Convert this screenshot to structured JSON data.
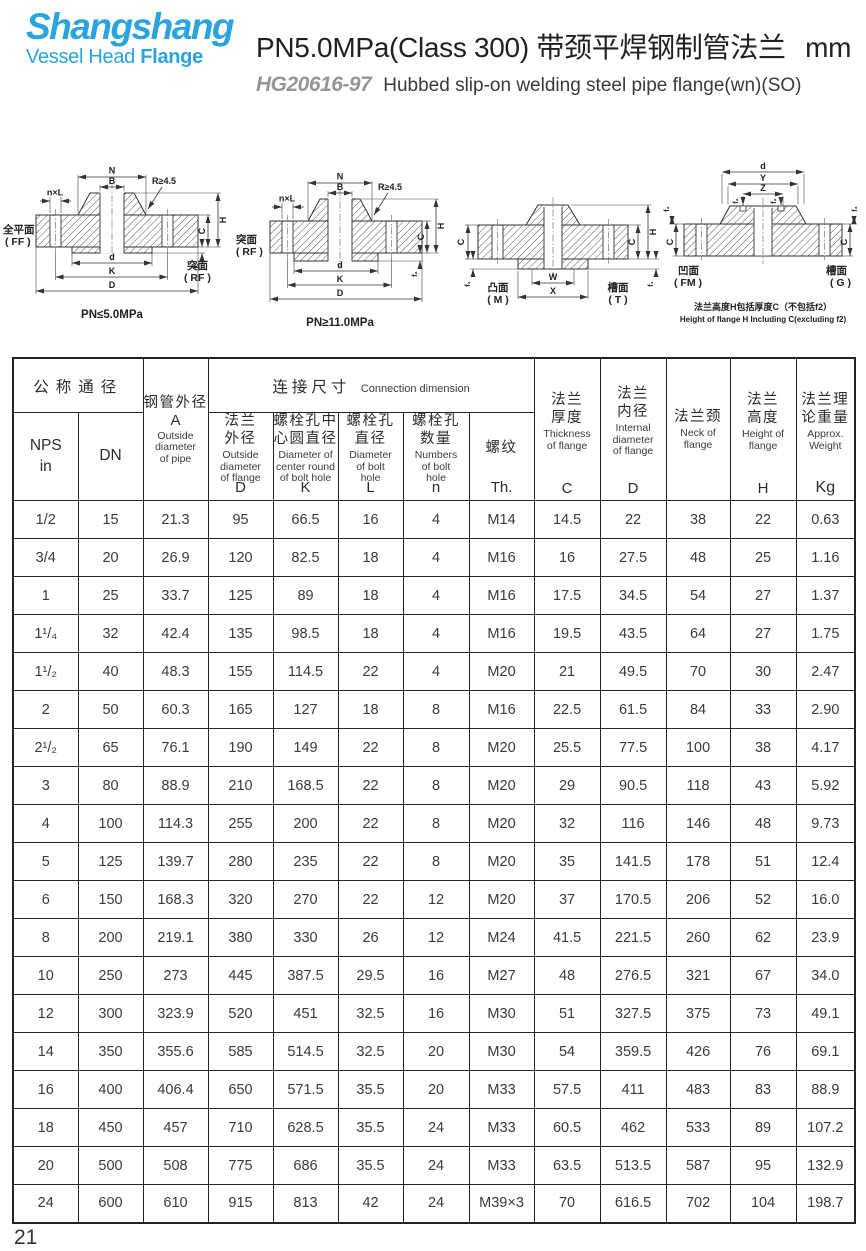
{
  "logo": {
    "name": "Shangshang",
    "tagline_a": "Vessel Head ",
    "tagline_b": "Flange"
  },
  "header": {
    "title_code": "PN5.0MPa(Class 300)",
    "title_zh": "带颈平焊钢制管法兰",
    "title_unit": "mm",
    "standard": "HG20616-97",
    "subtitle_en": "Hubbed slip-on welding steel pipe flange(wn)(SO)"
  },
  "drawings": {
    "d1": {
      "dim_n": "N",
      "dim_b": "B",
      "dim_nxl": "n×L",
      "dim_r": "R≥4.5",
      "dim_d": "d",
      "dim_k": "K",
      "dim_big_d": "D",
      "dim_h": "H",
      "dim_c": "C",
      "dim_f": "f₁",
      "face_left_zh": "全平面",
      "face_left_en": "( FF )",
      "face_right_zh": "突面",
      "face_right_en": "( RF )",
      "caption": "PN≤5.0MPa"
    },
    "d2": {
      "dim_n": "N",
      "dim_b": "B",
      "dim_nxl": "n×L",
      "dim_r": "R≥4.5",
      "dim_d": "d",
      "dim_k": "K",
      "dim_big_d": "D",
      "dim_h": "H",
      "dim_c": "C",
      "dim_f": "f₂",
      "face_left_zh": "突面",
      "face_left_en": "( RF )",
      "caption": "PN≥11.0MPa"
    },
    "d3": {
      "dim_c": "C",
      "dim_f": "f₂",
      "dim_w": "W",
      "dim_x": "X",
      "dim_h": "H",
      "face_left_zh": "凸面",
      "face_left_en": "( M )",
      "face_right_zh": "槽面",
      "face_right_en": "( T )"
    },
    "d4": {
      "dim_d": "d",
      "dim_y": "Y",
      "dim_z": "Z",
      "dim_f2": "f₂",
      "dim_f3": "f₃",
      "dim_c": "C",
      "face_left_zh": "凹面",
      "face_left_en": "( FM )",
      "face_right_zh": "槽面",
      "face_right_en": "( G )",
      "note_zh": "法兰高度H包括厚度C（不包括f2）",
      "note_en": "Height of flange H Including C(excluding f2)"
    }
  },
  "table": {
    "nominal_group": "公称通径",
    "connection_group_zh": "连接尺寸",
    "connection_group_en": "Connection dimension",
    "cols": [
      {
        "zh": "NPS\nin"
      },
      {
        "zh": "DN"
      },
      {
        "zh": "钢管外径",
        "sym": "A",
        "en": "Outside\ndiameter\nof pipe"
      },
      {
        "zh": "法兰\n外径",
        "en": "Outside\ndiameter\nof flange",
        "sym": "D"
      },
      {
        "zh": "螺栓孔中\n心圆直径",
        "en": "Diameter of\ncenter round\nof bolt hole",
        "sym": "K"
      },
      {
        "zh": "螺栓孔\n直径",
        "en": "Diameter\nof bolt\nhole",
        "sym": "L"
      },
      {
        "zh": "螺栓孔\n数量",
        "en": "Numbers\nof bolt\nhole",
        "sym": "n"
      },
      {
        "zh": "螺纹",
        "sym": "Th."
      },
      {
        "zh": "法兰\n厚度",
        "en": "Thickness\nof flange",
        "sym": "C"
      },
      {
        "zh": "法兰\n内径",
        "en": "Internal\ndiameter\nof flange",
        "sym": "D"
      },
      {
        "zh": "法兰颈",
        "en": "Neck of\nflange"
      },
      {
        "zh": "法兰\n高度",
        "en": "Height of\nflange",
        "sym": "H"
      },
      {
        "zh": "法兰理\n论重量",
        "en": "Approx.\nWeight",
        "sym": "Kg"
      }
    ],
    "rows": [
      [
        "1/2",
        "15",
        "21.3",
        "95",
        "66.5",
        "16",
        "4",
        "M14",
        "14.5",
        "22",
        "38",
        "22",
        "0.63"
      ],
      [
        "3/4",
        "20",
        "26.9",
        "120",
        "82.5",
        "18",
        "4",
        "M16",
        "16",
        "27.5",
        "48",
        "25",
        "1.16"
      ],
      [
        "1",
        "25",
        "33.7",
        "125",
        "89",
        "18",
        "4",
        "M16",
        "17.5",
        "34.5",
        "54",
        "27",
        "1.37"
      ],
      [
        "1¹/₄",
        "32",
        "42.4",
        "135",
        "98.5",
        "18",
        "4",
        "M16",
        "19.5",
        "43.5",
        "64",
        "27",
        "1.75"
      ],
      [
        "1¹/₂",
        "40",
        "48.3",
        "155",
        "114.5",
        "22",
        "4",
        "M20",
        "21",
        "49.5",
        "70",
        "30",
        "2.47"
      ],
      [
        "2",
        "50",
        "60.3",
        "165",
        "127",
        "18",
        "8",
        "M16",
        "22.5",
        "61.5",
        "84",
        "33",
        "2.90"
      ],
      [
        "2¹/₂",
        "65",
        "76.1",
        "190",
        "149",
        "22",
        "8",
        "M20",
        "25.5",
        "77.5",
        "100",
        "38",
        "4.17"
      ],
      [
        "3",
        "80",
        "88.9",
        "210",
        "168.5",
        "22",
        "8",
        "M20",
        "29",
        "90.5",
        "118",
        "43",
        "5.92"
      ],
      [
        "4",
        "100",
        "114.3",
        "255",
        "200",
        "22",
        "8",
        "M20",
        "32",
        "116",
        "146",
        "48",
        "9.73"
      ],
      [
        "5",
        "125",
        "139.7",
        "280",
        "235",
        "22",
        "8",
        "M20",
        "35",
        "141.5",
        "178",
        "51",
        "12.4"
      ],
      [
        "6",
        "150",
        "168.3",
        "320",
        "270",
        "22",
        "12",
        "M20",
        "37",
        "170.5",
        "206",
        "52",
        "16.0"
      ],
      [
        "8",
        "200",
        "219.1",
        "380",
        "330",
        "26",
        "12",
        "M24",
        "41.5",
        "221.5",
        "260",
        "62",
        "23.9"
      ],
      [
        "10",
        "250",
        "273",
        "445",
        "387.5",
        "29.5",
        "16",
        "M27",
        "48",
        "276.5",
        "321",
        "67",
        "34.0"
      ],
      [
        "12",
        "300",
        "323.9",
        "520",
        "451",
        "32.5",
        "16",
        "M30",
        "51",
        "327.5",
        "375",
        "73",
        "49.1"
      ],
      [
        "14",
        "350",
        "355.6",
        "585",
        "514.5",
        "32.5",
        "20",
        "M30",
        "54",
        "359.5",
        "426",
        "76",
        "69.1"
      ],
      [
        "16",
        "400",
        "406.4",
        "650",
        "571.5",
        "35.5",
        "20",
        "M33",
        "57.5",
        "411",
        "483",
        "83",
        "88.9"
      ],
      [
        "18",
        "450",
        "457",
        "710",
        "628.5",
        "35.5",
        "24",
        "M33",
        "60.5",
        "462",
        "533",
        "89",
        "107.2"
      ],
      [
        "20",
        "500",
        "508",
        "775",
        "686",
        "35.5",
        "24",
        "M33",
        "63.5",
        "513.5",
        "587",
        "95",
        "132.9"
      ],
      [
        "24",
        "600",
        "610",
        "915",
        "813",
        "42",
        "24",
        "M39×3",
        "70",
        "616.5",
        "702",
        "104",
        "198.7"
      ]
    ]
  },
  "page_number": "21",
  "colors": {
    "brand": "#29a4dc",
    "standard_gray": "#939598",
    "line": "#242424"
  }
}
